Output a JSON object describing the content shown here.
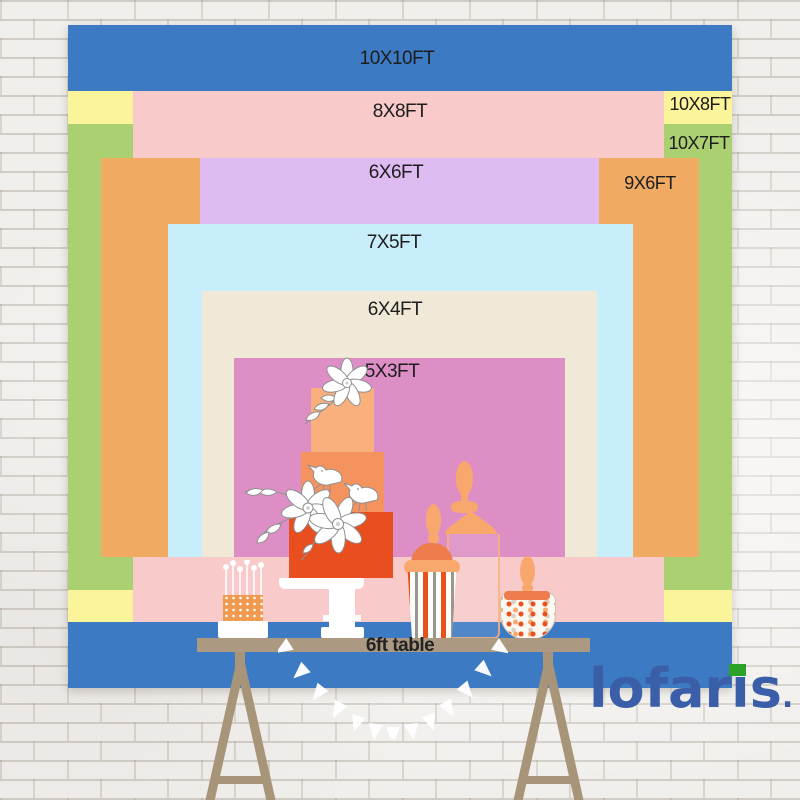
{
  "page": {
    "type": "backdrop-size-comparison-chart",
    "background": "white-brick-wall"
  },
  "banner": {
    "sizes": [
      {
        "label": "10X10FT",
        "width_ft": 10,
        "height_ft": 10,
        "color": "#3d7ac4"
      },
      {
        "label": "10X8FT",
        "width_ft": 10,
        "height_ft": 8,
        "color": "#fbf49b"
      },
      {
        "label": "10X7FT",
        "width_ft": 10,
        "height_ft": 7,
        "color": "#aad072"
      },
      {
        "label": "8X8FT",
        "width_ft": 8,
        "height_ft": 8,
        "color": "#f8caca"
      },
      {
        "label": "9X6FT",
        "width_ft": 9,
        "height_ft": 6,
        "color": "#f0aa62"
      },
      {
        "label": "6X6FT",
        "width_ft": 6,
        "height_ft": 6,
        "color": "#debbf1"
      },
      {
        "label": "7X5FT",
        "width_ft": 7,
        "height_ft": 5,
        "color": "#c9eefb"
      },
      {
        "label": "6X4FT",
        "width_ft": 6,
        "height_ft": 4,
        "color": "#f0e9d7"
      },
      {
        "label": "5X3FT",
        "width_ft": 5,
        "height_ft": 3,
        "color": "#dd8fc5"
      }
    ],
    "table_label": "6ft table",
    "label_color": "#1d1d1d"
  },
  "decor": {
    "items": [
      "tiered-cake",
      "sprinkle-cake",
      "cake-stand",
      "tall-glass-jar",
      "striped-candy-cup",
      "candy-bowl-jar",
      "pennant-garland",
      "trestle-table",
      "flowers",
      "birds"
    ],
    "cake_colors": [
      "#f9b07c",
      "#f5935f",
      "#e84e1e"
    ],
    "table_color": "#ab9982"
  },
  "logo": {
    "text": "lofaris",
    "part1": "lofar",
    "part2": "i",
    "part3": "s",
    "dot": ".",
    "color": "#3b5ea8",
    "flag_color": "#2ba32b"
  }
}
